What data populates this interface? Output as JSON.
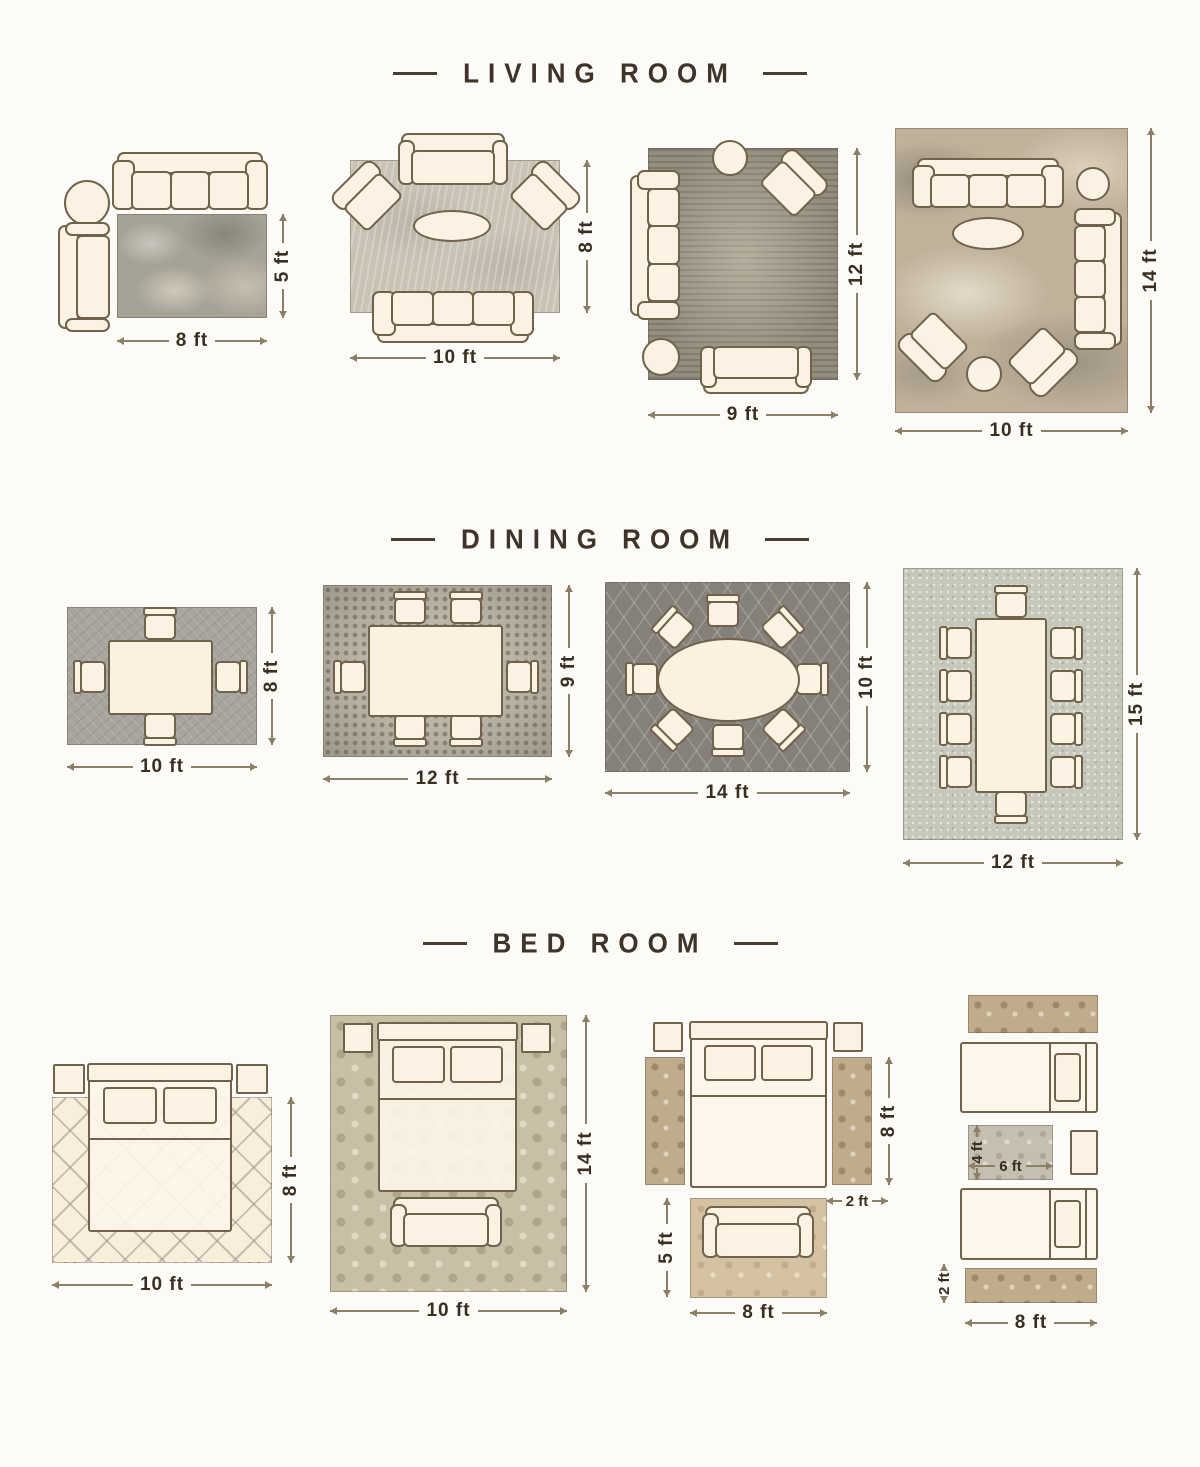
{
  "colors": {
    "background": "#fcfbf7",
    "title_text": "#40342a",
    "furniture_outline": "#71624b",
    "furniture_fill": "#fbf2e3",
    "dimension_line": "#8d7e66",
    "dimension_text": "#3a2e21"
  },
  "sections": [
    {
      "title": "LIVING ROOM",
      "diagrams": [
        {
          "width_label": "8 ft",
          "height_label": "5 ft"
        },
        {
          "width_label": "10 ft",
          "height_label": "8 ft"
        },
        {
          "width_label": "9 ft",
          "height_label": "12 ft"
        },
        {
          "width_label": "10 ft",
          "height_label": "14 ft"
        }
      ]
    },
    {
      "title": "DINING ROOM",
      "diagrams": [
        {
          "width_label": "10 ft",
          "height_label": "8 ft"
        },
        {
          "width_label": "12 ft",
          "height_label": "9 ft"
        },
        {
          "width_label": "14 ft",
          "height_label": "10 ft"
        },
        {
          "width_label": "12 ft",
          "height_label": "15 ft"
        }
      ]
    },
    {
      "title": "BED ROOM",
      "diagrams": [
        {
          "width_label": "10 ft",
          "height_label": "8 ft"
        },
        {
          "width_label": "10 ft",
          "height_label": "14 ft"
        },
        {
          "runner_height_label": "8 ft",
          "runner_width_label": "2 ft",
          "bench_rug_height_label": "5 ft",
          "bench_rug_width_label": "8 ft"
        },
        {
          "middle_rug_height_label": "4 ft",
          "middle_rug_width_label": "6 ft",
          "runner_height_label": "2 ft",
          "runner_width_label": "8 ft"
        }
      ]
    }
  ]
}
